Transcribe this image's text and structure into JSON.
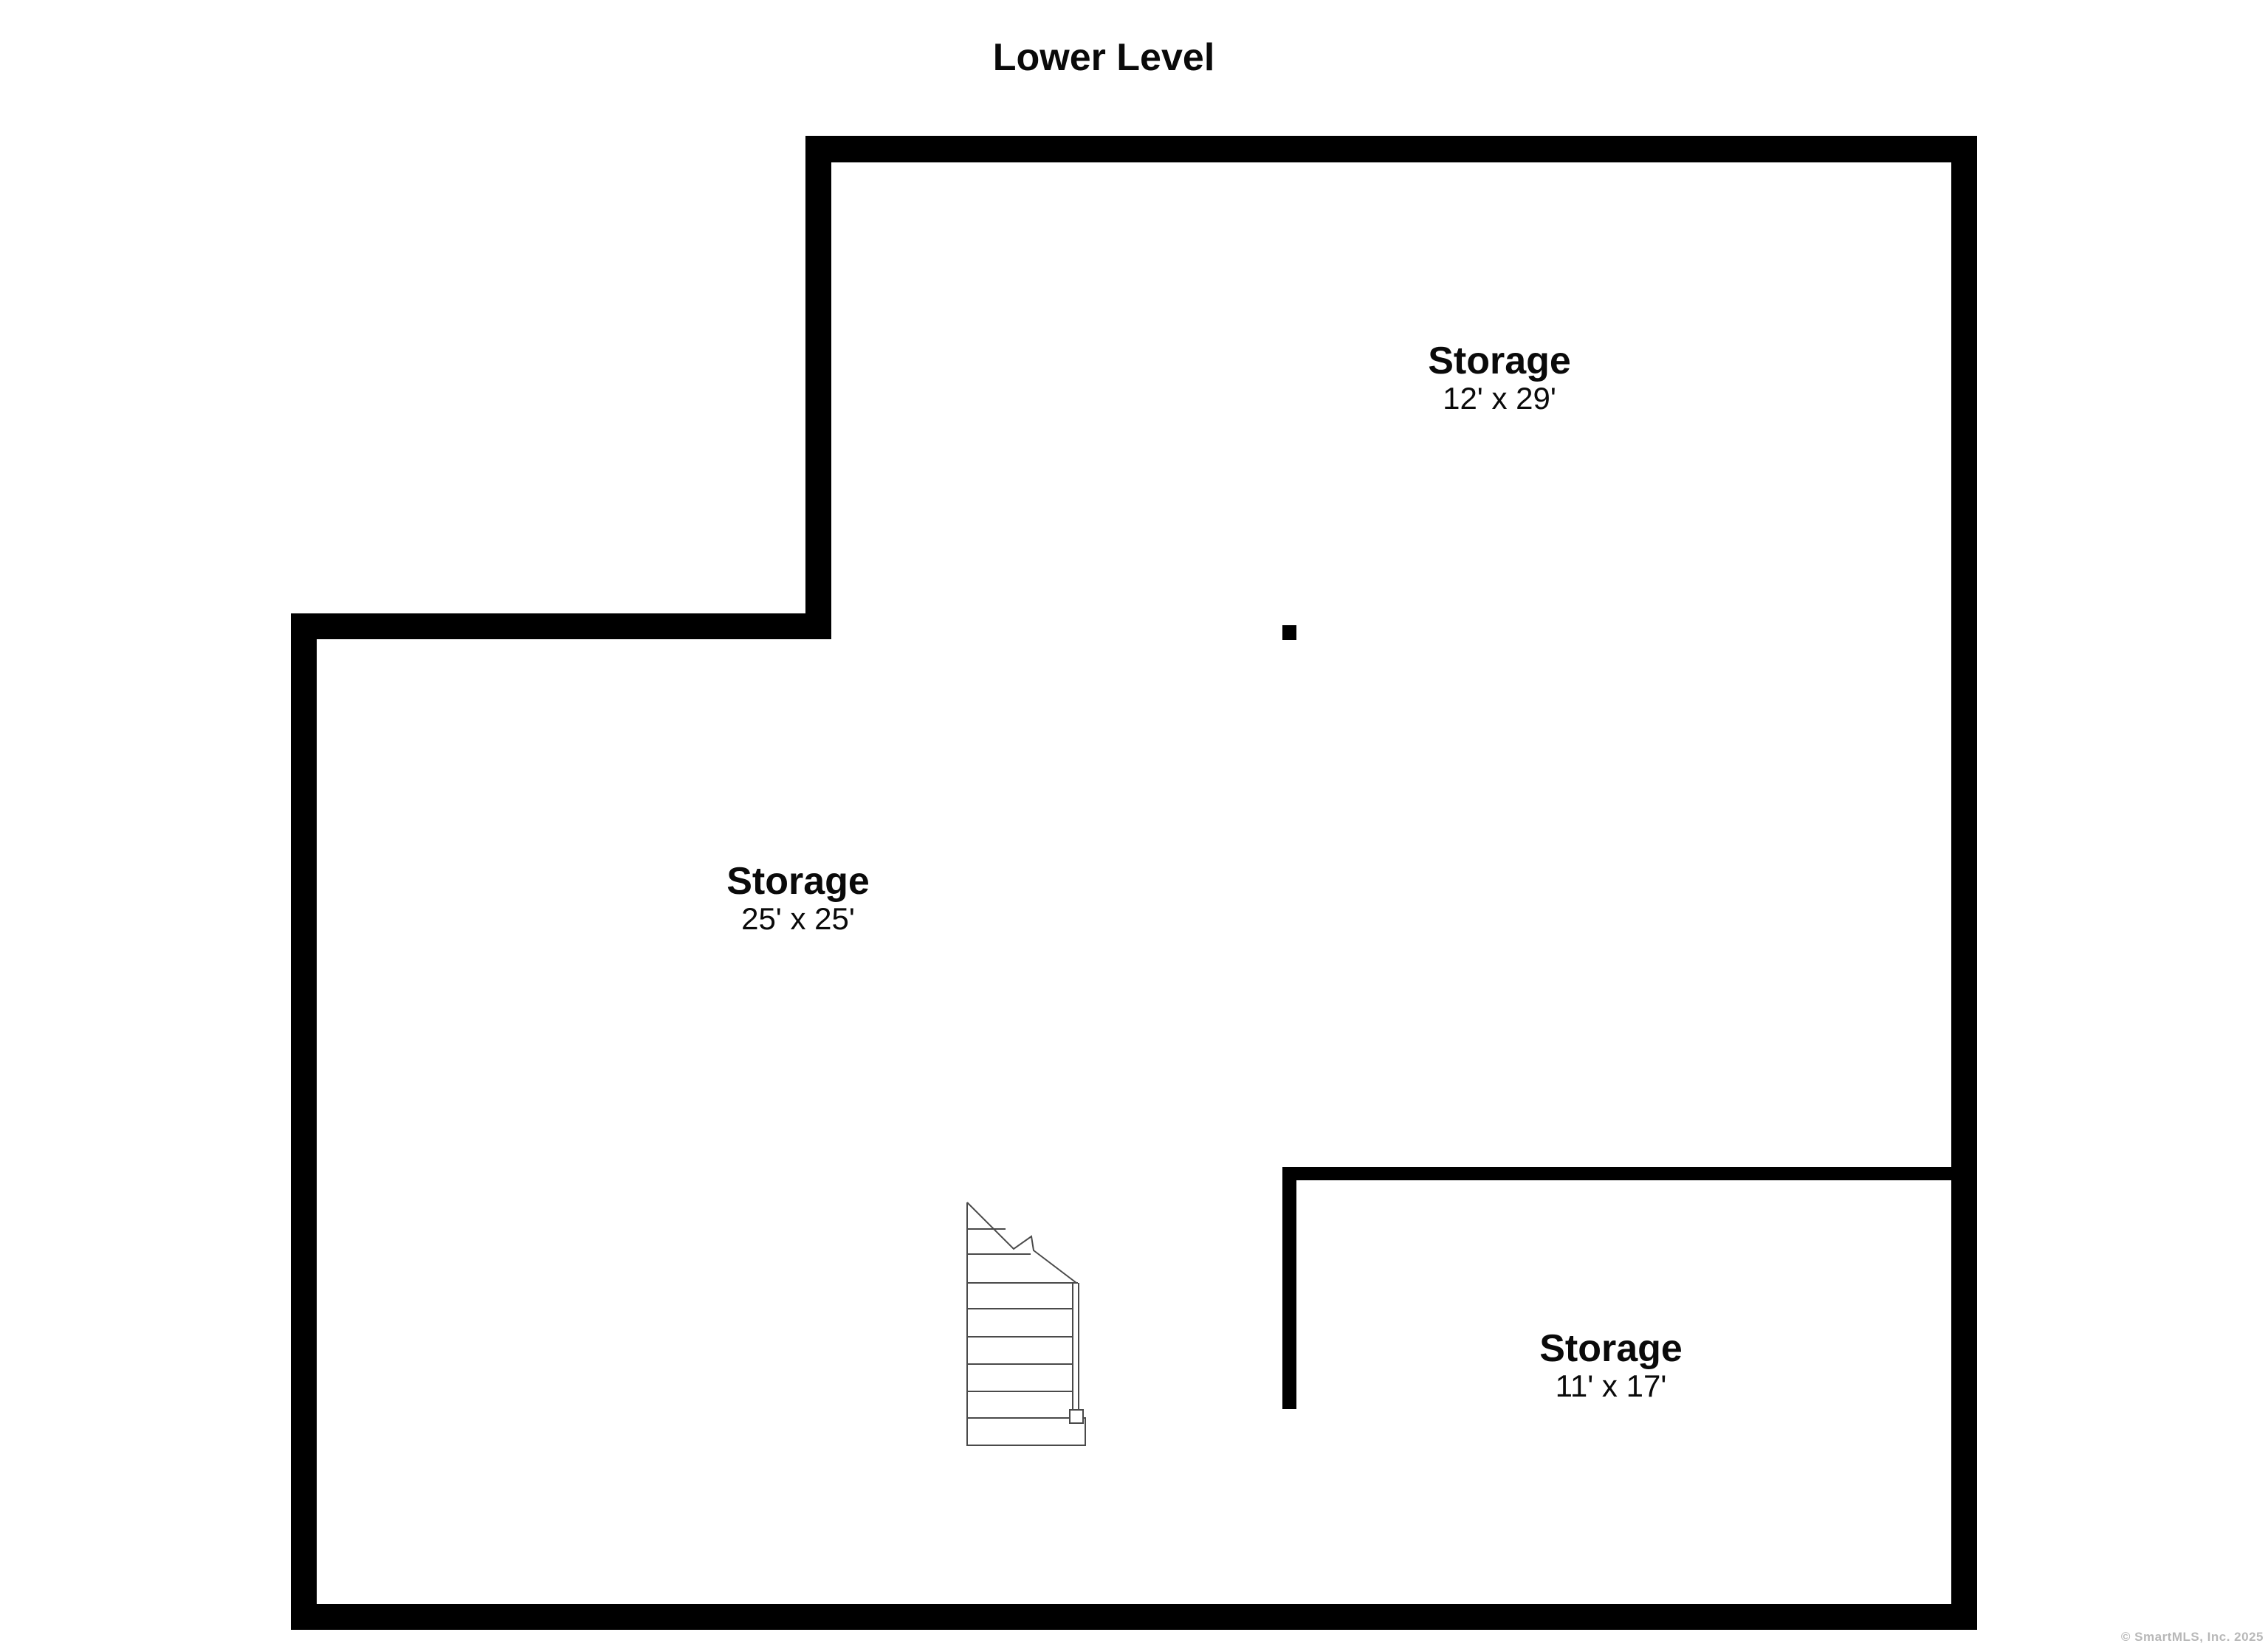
{
  "title": "Lower Level",
  "floor_plan": {
    "rooms": [
      {
        "name": "Storage",
        "dimensions": "12' x 29'"
      },
      {
        "name": "Storage",
        "dimensions": "25' x 25'"
      },
      {
        "name": "Storage",
        "dimensions": "11' x 17'"
      }
    ],
    "symbols": [
      {
        "name": "stairs-icon",
        "description": "staircase with break line, handrail and bottom landing"
      }
    ]
  },
  "footer": {
    "copyright": "© SmartMLS, Inc.  2025"
  },
  "colors": {
    "background": "#ffffff",
    "wall": "#000000",
    "stair_line": "#4a4a4a",
    "footer_text": "#b8b8b8"
  }
}
